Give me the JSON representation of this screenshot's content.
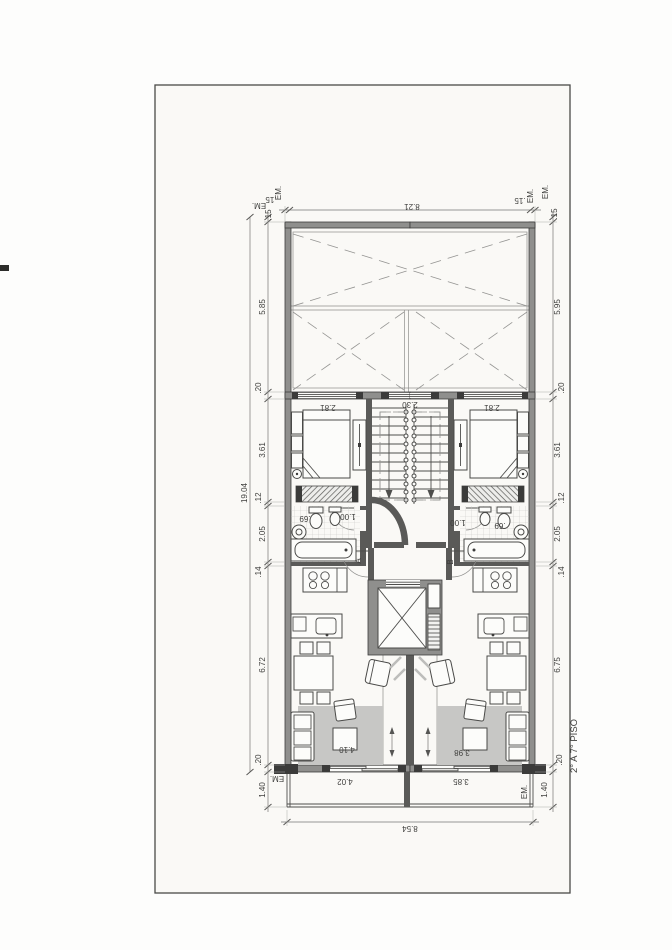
{
  "scan": {
    "page_bg": "#faf9f6",
    "line_color": "#4a4a4a"
  },
  "title": "2° A 7° PISO",
  "units": {
    "left": "A",
    "right": "B"
  },
  "em": "EM.",
  "dims": {
    "top": {
      "left_end": ".15",
      "total": "8.21",
      "right_end": ".15"
    },
    "overall_depth": "19.04",
    "left": {
      "end": ".15",
      "void": "5.85",
      "wall_a": ".20",
      "bedroom": "3.61",
      "wall_b": ".12",
      "bath": "2.05",
      "wall_c": ".14",
      "living": "6.72",
      "wall_d": ".20",
      "balcony": "1.40"
    },
    "right": {
      "end": ".15",
      "void": "5.95",
      "wall_a": ".20",
      "bedroom": "3.61",
      "wall_b": ".12",
      "bath": "2.05",
      "wall_c": ".14",
      "living": "6.75",
      "wall_d": ".20",
      "balcony": "1.40"
    },
    "bottom_total": "8.54"
  },
  "rooms": {
    "bedroom_left": "2.81",
    "stair_width": "2.30",
    "bedroom_right": "2.81",
    "hall_left": "1.00",
    "hall_right": "1.00",
    "bath_left": ".69",
    "bath_right": ".69",
    "living_left": "4.10",
    "living_right": "3.98",
    "balcony_left": "4.02",
    "balcony_right": "3.85"
  }
}
